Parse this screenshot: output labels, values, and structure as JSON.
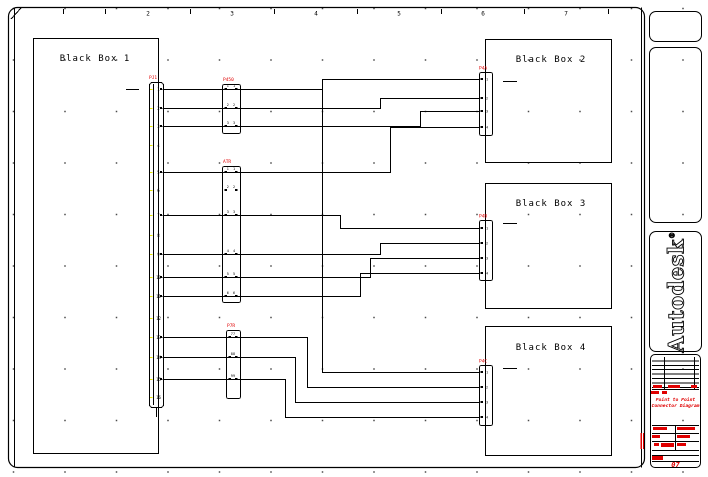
{
  "colors": {
    "line": "#000000",
    "red": "#e00000",
    "yellow": "#e6e600",
    "dot": "#4a4a4a"
  },
  "ruler": {
    "ticks": [
      63,
      105,
      190,
      274,
      357,
      441,
      524,
      608
    ],
    "numbers": [
      {
        "label": "2",
        "x": 148
      },
      {
        "label": "3",
        "x": 232
      },
      {
        "label": "4",
        "x": 316
      },
      {
        "label": "5",
        "x": 399
      },
      {
        "label": "6",
        "x": 483
      },
      {
        "label": "7",
        "x": 566
      }
    ]
  },
  "diagram": {
    "boxes": [
      {
        "id": "black-box-1",
        "label": "Black Box 1",
        "x": 33,
        "y": 38,
        "w": 125,
        "h": 415,
        "label_cx": 95,
        "label_y": 61,
        "dash": [
          126,
          89,
          139,
          89
        ]
      },
      {
        "id": "black-box-2",
        "label": "Black Box 2",
        "x": 485,
        "y": 39,
        "w": 126,
        "h": 123,
        "label_cx": 551,
        "label_y": 62,
        "dash": [
          503,
          81,
          517,
          81
        ]
      },
      {
        "id": "black-box-3",
        "label": "Black Box 3",
        "x": 485,
        "y": 183,
        "w": 126,
        "h": 125,
        "label_cx": 551,
        "label_y": 206,
        "dash": [
          503,
          223,
          517,
          223
        ]
      },
      {
        "id": "black-box-4",
        "label": "Black Box 4",
        "x": 485,
        "y": 326,
        "w": 126,
        "h": 129,
        "label_cx": 551,
        "label_y": 350,
        "dash": [
          503,
          368,
          517,
          368
        ]
      }
    ],
    "strip": {
      "label": "PJ1",
      "x": 149,
      "y": 82,
      "w": 14,
      "h": 325,
      "pin_ys": [
        89,
        108,
        126,
        145,
        172,
        190,
        215,
        235,
        254,
        277,
        296,
        318,
        337,
        357,
        379,
        397
      ],
      "tail": [
        156,
        407,
        156,
        417
      ]
    },
    "mid_connectors": [
      {
        "label": "P450",
        "x": 222,
        "y": 84,
        "w": 18,
        "h": 49,
        "pins": [
          89,
          108,
          126
        ],
        "pin_labels": [
          "1",
          "2",
          "3"
        ]
      },
      {
        "label": "ATR",
        "x": 222,
        "y": 166,
        "w": 18,
        "h": 136,
        "pins": [
          172,
          190,
          215,
          254,
          277,
          296
        ],
        "pin_labels": [
          "1",
          "2",
          "3",
          "4",
          "5",
          "6"
        ]
      },
      {
        "label": "P7R",
        "x": 226,
        "y": 330,
        "w": 14,
        "h": 68,
        "pins": [
          337,
          357,
          379
        ],
        "pin_labels": [
          "7",
          "8",
          "9"
        ]
      }
    ],
    "box_connectors": [
      {
        "label": "P4A",
        "x": 479,
        "y": 72,
        "w": 13,
        "h": 63,
        "pins": [
          79,
          98,
          111,
          127
        ],
        "pin_labels": [
          "1",
          "2",
          "3",
          "4"
        ]
      },
      {
        "label": "P4B",
        "x": 479,
        "y": 220,
        "w": 13,
        "h": 60,
        "pins": [
          228,
          243,
          258,
          273
        ],
        "pin_labels": [
          "1",
          "2",
          "3",
          "4"
        ]
      },
      {
        "label": "P4C",
        "x": 479,
        "y": 365,
        "w": 13,
        "h": 60,
        "pins": [
          372,
          387,
          402,
          417
        ],
        "pin_labels": [
          "1",
          "2",
          "3",
          "4"
        ]
      }
    ],
    "wires": [
      [
        [
          162,
          89
        ],
        [
          322,
          89
        ],
        [
          322,
          79
        ],
        [
          479,
          79
        ]
      ],
      [
        [
          162,
          108
        ],
        [
          380,
          108
        ],
        [
          380,
          98
        ],
        [
          479,
          98
        ]
      ],
      [
        [
          162,
          126
        ],
        [
          420,
          126
        ],
        [
          420,
          111
        ],
        [
          479,
          111
        ]
      ],
      [
        [
          162,
          172
        ],
        [
          390,
          172
        ],
        [
          390,
          127
        ],
        [
          479,
          127
        ]
      ],
      [
        [
          162,
          215
        ],
        [
          340,
          215
        ],
        [
          340,
          228
        ],
        [
          479,
          228
        ]
      ],
      [
        [
          162,
          254
        ],
        [
          380,
          254
        ],
        [
          380,
          243
        ],
        [
          479,
          243
        ]
      ],
      [
        [
          162,
          277
        ],
        [
          370,
          277
        ],
        [
          370,
          258
        ],
        [
          479,
          258
        ]
      ],
      [
        [
          162,
          296
        ],
        [
          360,
          296
        ],
        [
          360,
          273
        ],
        [
          479,
          273
        ]
      ],
      [
        [
          322,
          89
        ],
        [
          322,
          372
        ],
        [
          479,
          372
        ]
      ],
      [
        [
          162,
          337
        ],
        [
          307,
          337
        ],
        [
          307,
          387
        ],
        [
          479,
          387
        ]
      ],
      [
        [
          162,
          357
        ],
        [
          295,
          357
        ],
        [
          295,
          402
        ],
        [
          479,
          402
        ]
      ],
      [
        [
          162,
          379
        ],
        [
          285,
          379
        ],
        [
          285,
          417
        ],
        [
          479,
          417
        ]
      ]
    ]
  },
  "side": {
    "logo": "Autodesk",
    "logo_reg": "®",
    "titleblock": {
      "title1": "Point to Point",
      "title2": "Connector Diagram",
      "sheet": "07"
    }
  }
}
